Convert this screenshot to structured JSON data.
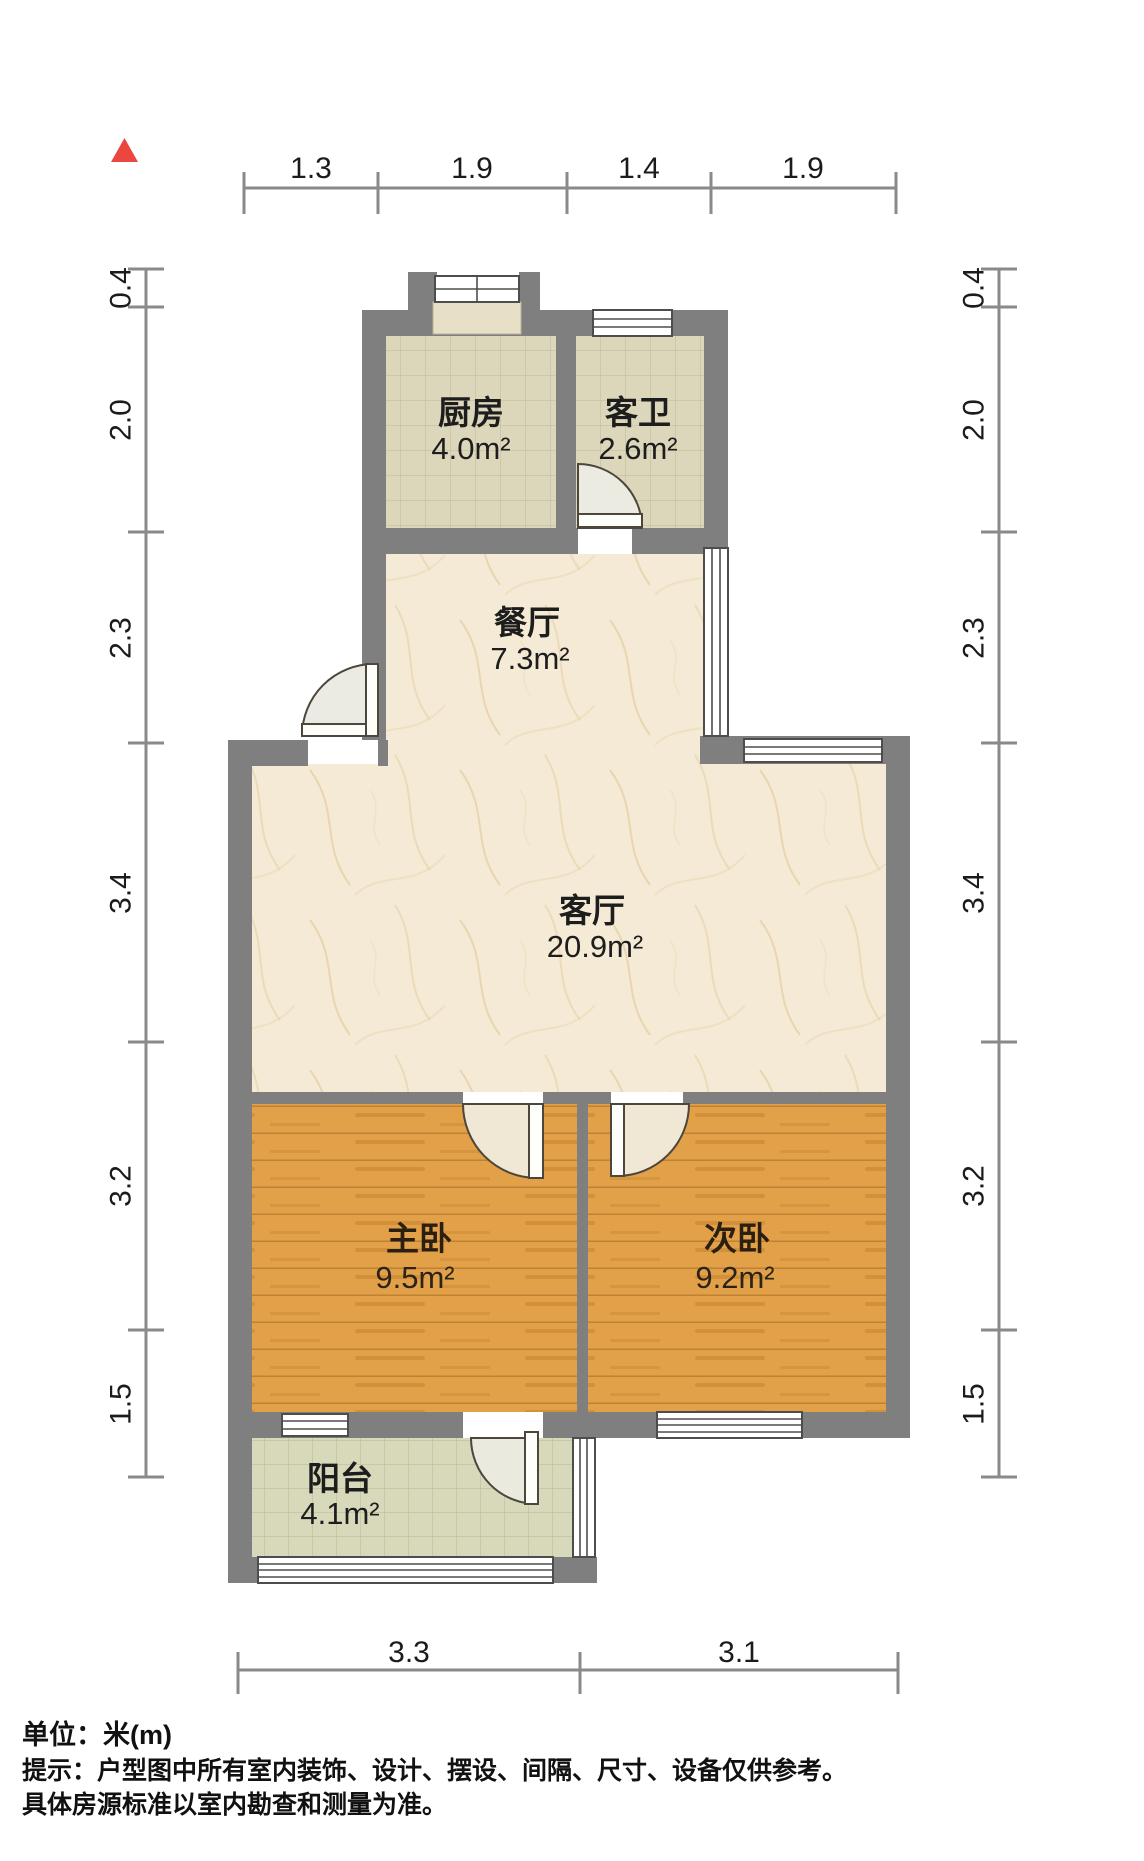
{
  "north_indicator": {
    "shape": "triangle",
    "color": "#e94740"
  },
  "dimensions": {
    "unit": "m",
    "top": [
      "1.3",
      "1.9",
      "1.4",
      "1.9"
    ],
    "bottom": [
      "3.3",
      "3.1"
    ],
    "left": [
      "0.4",
      "2.0",
      "2.3",
      "3.4",
      "3.2",
      "1.5"
    ],
    "right": [
      "0.4",
      "2.0",
      "2.3",
      "3.4",
      "3.2",
      "1.5"
    ]
  },
  "rooms": {
    "kitchen": {
      "name": "厨房",
      "area": "4.0m²",
      "floor": "tile"
    },
    "guest_bath": {
      "name": "客卫",
      "area": "2.6m²",
      "floor": "tile"
    },
    "dining": {
      "name": "餐厅",
      "area": "7.3m²",
      "floor": "marble"
    },
    "living": {
      "name": "客厅",
      "area": "20.9m²",
      "floor": "marble"
    },
    "master_bedroom": {
      "name": "主卧",
      "area": "9.5m²",
      "floor": "wood"
    },
    "second_bedroom": {
      "name": "次卧",
      "area": "9.2m²",
      "floor": "wood"
    },
    "balcony": {
      "name": "阳台",
      "area": "4.1m²",
      "floor": "tile"
    }
  },
  "footer": {
    "unit": "单位：米(m)",
    "tip1": "提示：户型图中所有室内装饰、设计、摆设、间隔、尺寸、设备仅供参考。",
    "tip2": "具体房源标准以室内勘查和测量为准。"
  },
  "colors": {
    "wall": "#7f7f7f",
    "tile_floor": "#dcd6bb",
    "balcony_floor": "#d8d8ba",
    "marble_floor": "#f4ead5",
    "wood_floor": "#e2a049",
    "dimension_line": "#8a8a8a",
    "north_marker": "#e94740"
  }
}
